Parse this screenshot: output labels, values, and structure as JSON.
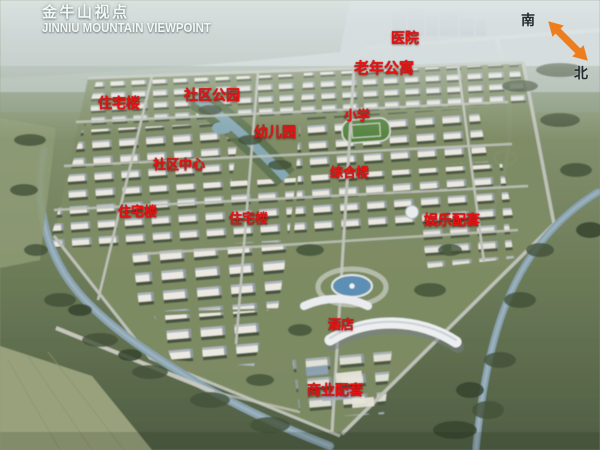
{
  "title": {
    "zh": "金牛山视点",
    "en": "JINNIU MOUNTAIN VIEWPOINT"
  },
  "compass": {
    "south": "南",
    "north": "北"
  },
  "map_labels": [
    {
      "text": "医院"
    },
    {
      "text": "老年公寓"
    },
    {
      "text": "住宅楼"
    },
    {
      "text": "社区公园"
    },
    {
      "text": "幼儿园"
    },
    {
      "text": "小学"
    },
    {
      "text": "社区中心"
    },
    {
      "text": "综合楼"
    },
    {
      "text": "住宅楼"
    },
    {
      "text": "住宅楼"
    },
    {
      "text": "娱乐配套"
    },
    {
      "text": "酒店"
    },
    {
      "text": "商业配套"
    }
  ],
  "colors": {
    "label_red": "#e21414",
    "compass_orange": "#ed7d1d",
    "title_white": "#f4f7f4",
    "water_blue": "#8aa3b0",
    "ground_green": "#6d7c58"
  }
}
